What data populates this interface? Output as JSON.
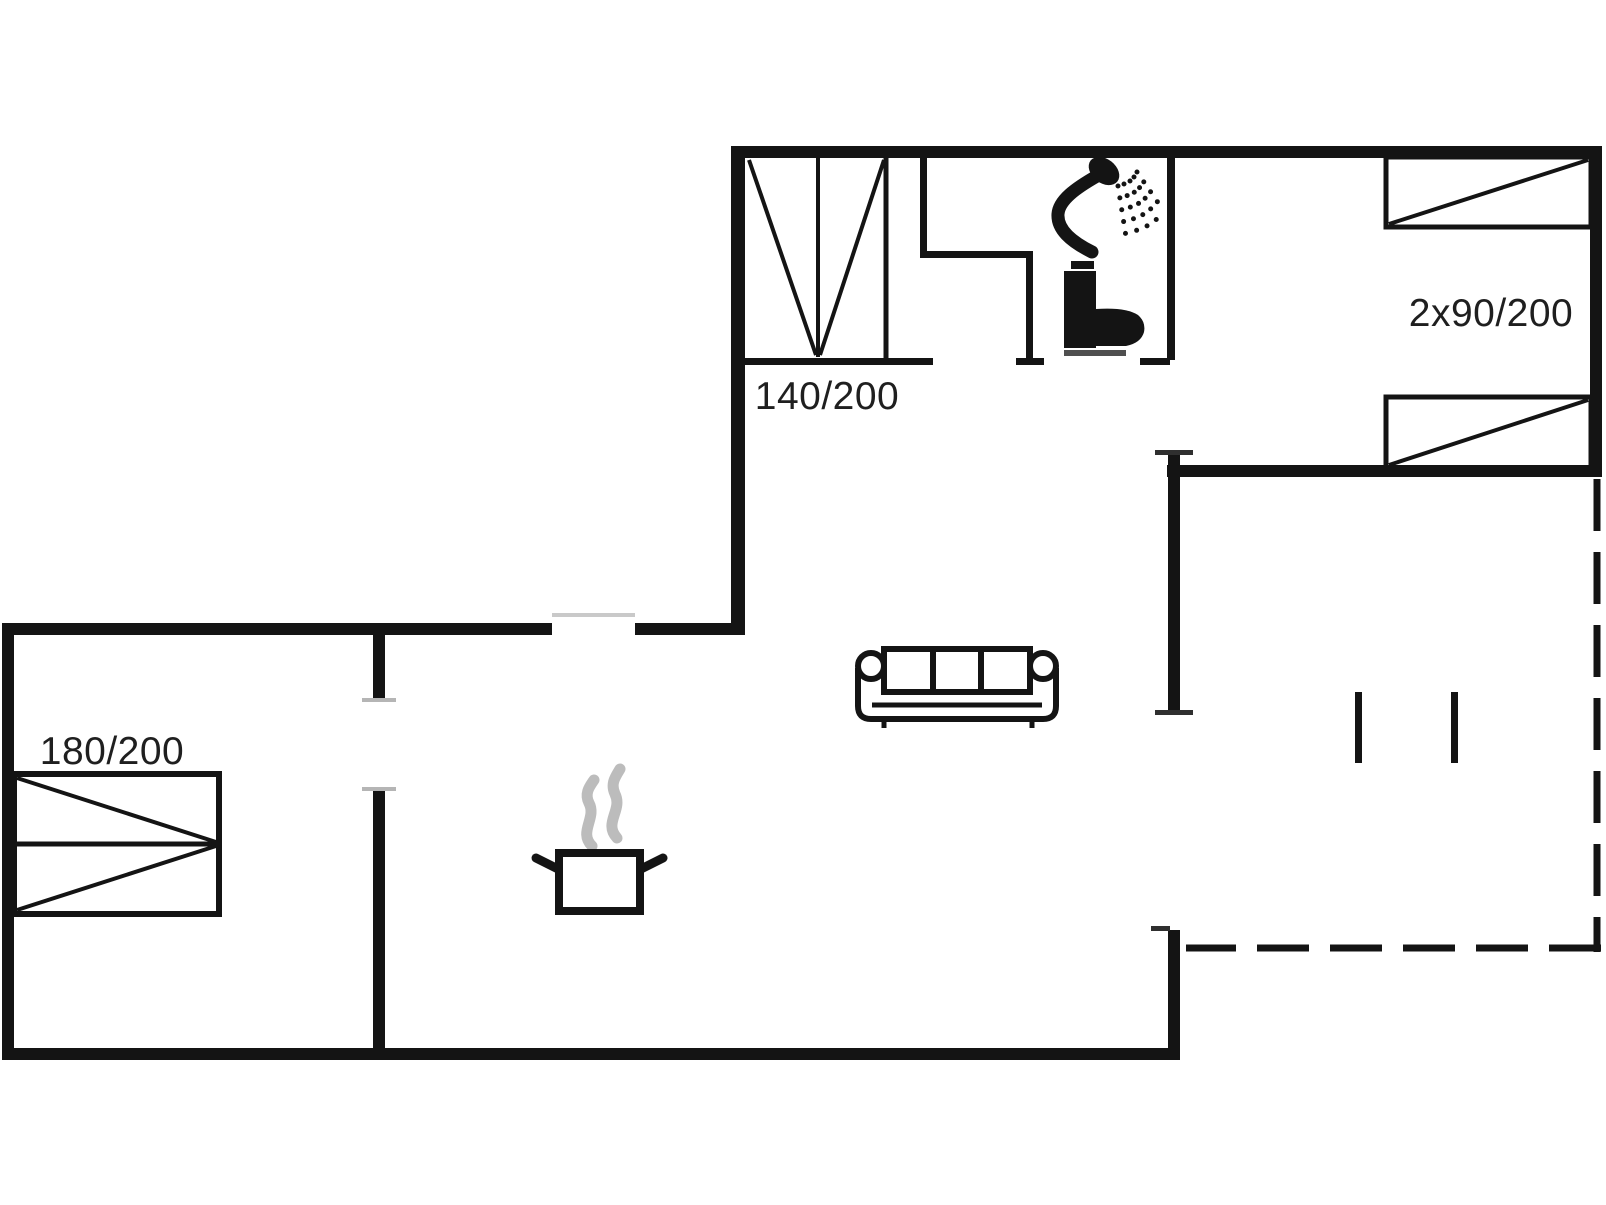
{
  "floorplan": {
    "labels": {
      "bed_140": "140/200",
      "bed_180": "180/200",
      "bed_2x90": "2x90/200"
    },
    "colors": {
      "wall": "#141414",
      "background": "#ffffff",
      "label_text": "#1f1f1f",
      "steam": "#bcbcbc",
      "toilet_base": "#4f4f4f",
      "window_line": "#c9c9c9",
      "door_tick_dark": "#2f2f2f",
      "door_tick_light": "#b5b5b5"
    },
    "icons": {
      "shower": "shower-icon",
      "toilet": "toilet-icon",
      "sofa": "sofa-icon",
      "cooking_pot": "cooking-pot-icon",
      "bed_symbol": "bed-symbol",
      "terrace_boundary": "terrace-dashed-boundary"
    }
  }
}
